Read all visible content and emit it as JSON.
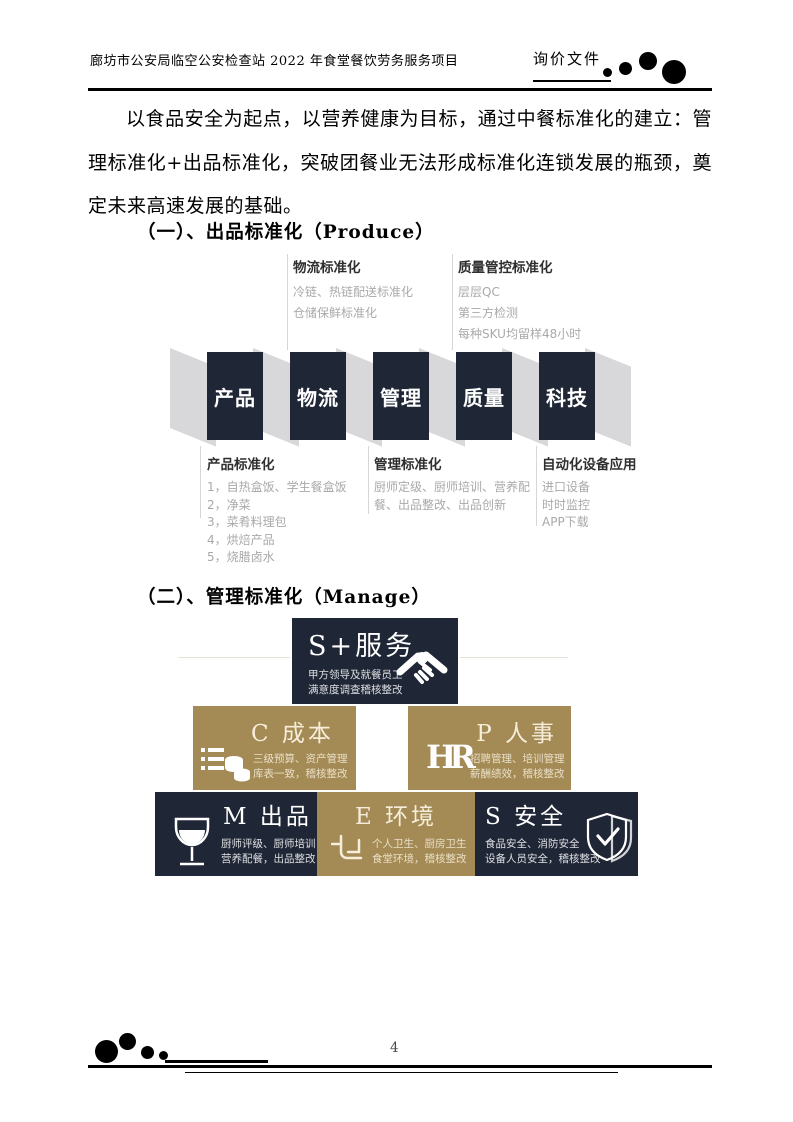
{
  "header": {
    "title": "廊坊市公安局临空公安检查站 2022 年食堂餐饮劳务服务项目",
    "doc_type": "询价文件"
  },
  "paragraph": "以食品安全为起点，以营养健康为目标，通过中餐标准化的建立：管理标准化+出品标准化，突破团餐业无法形成标准化连锁发展的瓶颈，奠定未来高速发展的基础。",
  "section1": {
    "heading": "（一）、出品标准化（Produce）"
  },
  "section2": {
    "heading": "（二）、管理标准化（Manage）"
  },
  "produce_diagram": {
    "top_groups": [
      {
        "title": "物流标准化",
        "items": [
          "冷链、热链配送标准化",
          "仓储保鲜标准化"
        ]
      },
      {
        "title": "质量管控标准化",
        "items": [
          "层层QC",
          "第三方检测",
          "每种SKU均留样48小时"
        ]
      }
    ],
    "boxes": [
      "产品",
      "物流",
      "管理",
      "质量",
      "科技"
    ],
    "bottom_groups": [
      {
        "title": "产品标准化",
        "items": [
          "1，自热盒饭、学生餐盒饭",
          "2，净菜",
          "3，菜肴料理包",
          "4，烘焙产品",
          "5，烧腊卤水"
        ]
      },
      {
        "title": "管理标准化",
        "items": [
          "厨师定级、厨师培训、营养配餐、出品整改、出品创新"
        ]
      },
      {
        "title": "自动化设备应用",
        "items": [
          "进口设备",
          "时时监控",
          "APP下载"
        ]
      }
    ]
  },
  "manage_diagram": {
    "blocks": [
      {
        "title": "S+服务",
        "desc1": "甲方领导及就餐员工",
        "desc2": "满意度调查稽核整改",
        "icon": "handshake-icon"
      },
      {
        "title": "C 成本",
        "desc1": "三级预算、资产管理",
        "desc2": "库表一致，稽核整改",
        "icon": "ledger-coins-icon"
      },
      {
        "title": "P 人事",
        "desc1": "招聘管理、培训管理",
        "desc2": "薪酬绩效，稽核整改",
        "icon": "hr-icon",
        "hr_glyph": "HR"
      },
      {
        "title": "M 出品",
        "desc1": "厨师评级、厨师培训",
        "desc2": "营养配餐，出品整改",
        "icon": "wine-glass-icon"
      },
      {
        "title": "E 环境",
        "desc1": "个人卫生、厨房卫生",
        "desc2": "食堂环境，稽核整改",
        "icon": "floorplan-icon"
      },
      {
        "title": "S 安全",
        "desc1": "食品安全、消防安全",
        "desc2": "设备人员安全，稽核整改",
        "icon": "shield-check-icon"
      }
    ]
  },
  "footer": {
    "page_number": "4"
  },
  "colors": {
    "navy": "#1f2636",
    "gold": "#a48a55",
    "gray_shape": "#d8d8db",
    "muted_text": "#a9a9ab"
  }
}
